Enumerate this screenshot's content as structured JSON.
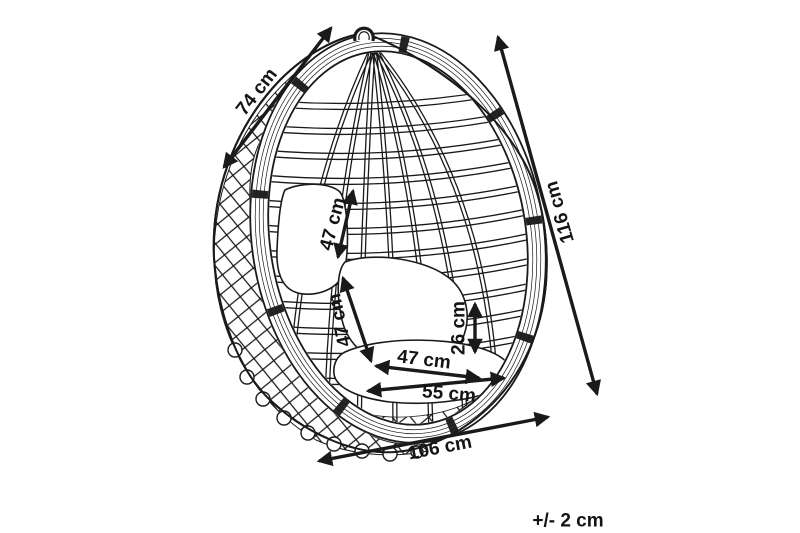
{
  "diagram": {
    "unit": "cm",
    "background_color": "#ffffff",
    "line_color": "#1a1a1a",
    "dimensions": {
      "diagonal_top_width": {
        "label": "74 cm",
        "value": 74
      },
      "total_height": {
        "label": "116 cm",
        "value": 116
      },
      "back_cushion_height": {
        "label": "47 cm",
        "value": 47
      },
      "seat_back_cushion_height": {
        "label": "47 cm",
        "value": 47
      },
      "seat_cushion_height": {
        "label": "26 cm",
        "value": 26
      },
      "seat_depth": {
        "label": "47 cm",
        "value": 47
      },
      "seat_width": {
        "label": "55 cm",
        "value": 55
      },
      "overall_width": {
        "label": "106 cm",
        "value": 106
      }
    },
    "tolerance": {
      "label": "+/- 2 cm"
    }
  }
}
